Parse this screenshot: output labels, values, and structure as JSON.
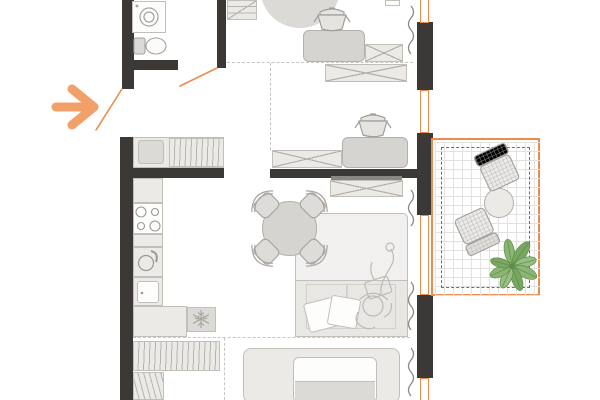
{
  "title": "apartment-floor-plan",
  "colors": {
    "bg": "#ffffff",
    "wall": "#3b3835",
    "orange": "#e98c4e",
    "arrow": "#f0a068",
    "outline": "#b3b0ac",
    "outline2": "#c2bfbb",
    "hatch": "#b7b4b0",
    "fill1": "#eceae7",
    "fill2": "#dcdad7",
    "fill3": "#d6d4d1",
    "white": "#fdfdfc",
    "rug": "#f1f0ee",
    "seat": "#e9e7e4",
    "tv": "#8a8783",
    "dash": "#c8c5c1",
    "bdash": "#6f6c69",
    "grid": "#e4e2e0",
    "curtain": "#8d8a86",
    "sketch": "#bdbab6",
    "green": "#8cb573",
    "green2": "#79a761",
    "green3": "#97bd80",
    "greend": "#5f8c4b",
    "wicker": "#b1aeaa"
  },
  "rooms": [
    {
      "name": "entry-hall",
      "furniture": [
        "entrance-arrow",
        "door-swing",
        "closet"
      ]
    },
    {
      "name": "bathroom",
      "furniture": [
        "washing-machine",
        "toilet"
      ]
    },
    {
      "name": "bedroom-top",
      "furniture": [
        "dresser",
        "round-rug",
        "armchair",
        "plant-pot",
        "storage-box"
      ]
    },
    {
      "name": "bedroom-middle",
      "furniture": [
        "storage-box",
        "armchair",
        "plant-pot"
      ]
    },
    {
      "name": "kitchen",
      "furniture": [
        "counter",
        "stove",
        "sink",
        "cabinet",
        "fridge",
        "wardrobe",
        "wardrobe-small"
      ]
    },
    {
      "name": "living-room",
      "furniture": [
        "tv-console",
        "dining-table",
        "dining-chairs-x4",
        "sofa",
        "pillows",
        "person-illustration"
      ]
    },
    {
      "name": "sleeping-area",
      "furniture": [
        "bed"
      ]
    },
    {
      "name": "balcony",
      "furniture": [
        "wicker-chair",
        "wicker-chair",
        "round-table",
        "plant"
      ]
    }
  ],
  "annotations": {
    "entrance_arrow_direction": "right",
    "windows_count": 4,
    "balcony_floor": "tile-grid"
  }
}
